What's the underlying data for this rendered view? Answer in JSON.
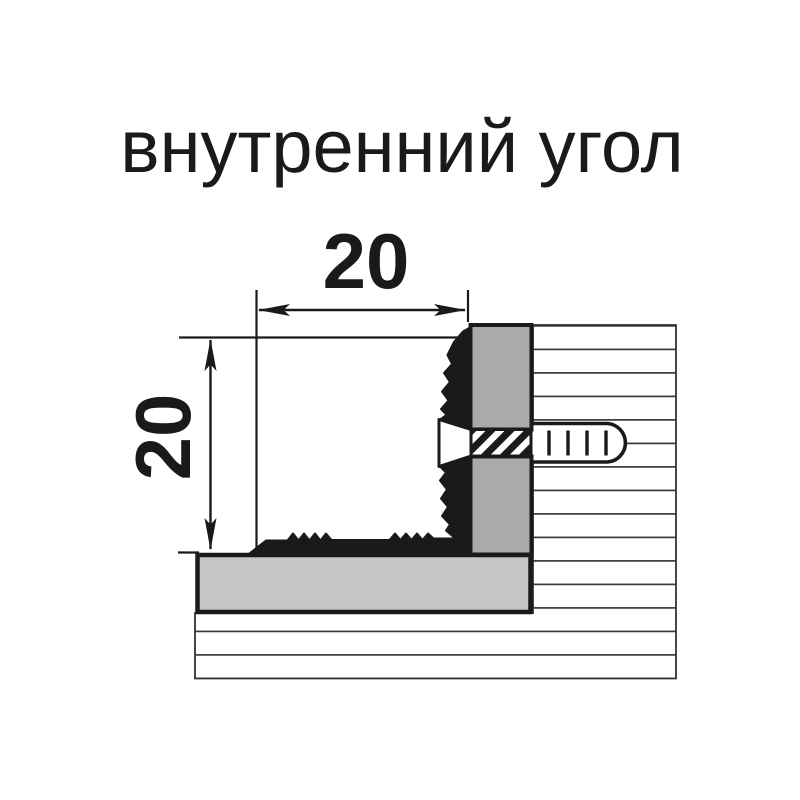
{
  "title": "внутренний угол",
  "dimensions": {
    "width_label": "20",
    "height_label": "20"
  },
  "colors": {
    "background": "#ffffff",
    "outline": "#1a1a1a",
    "thin_line": "#333333",
    "hatch_line": "#3a3a3a",
    "wall_block_gray": "#aaaaaa",
    "floor_slab_gray": "#c6c6c6",
    "screw_fill": "#ffffff"
  }
}
